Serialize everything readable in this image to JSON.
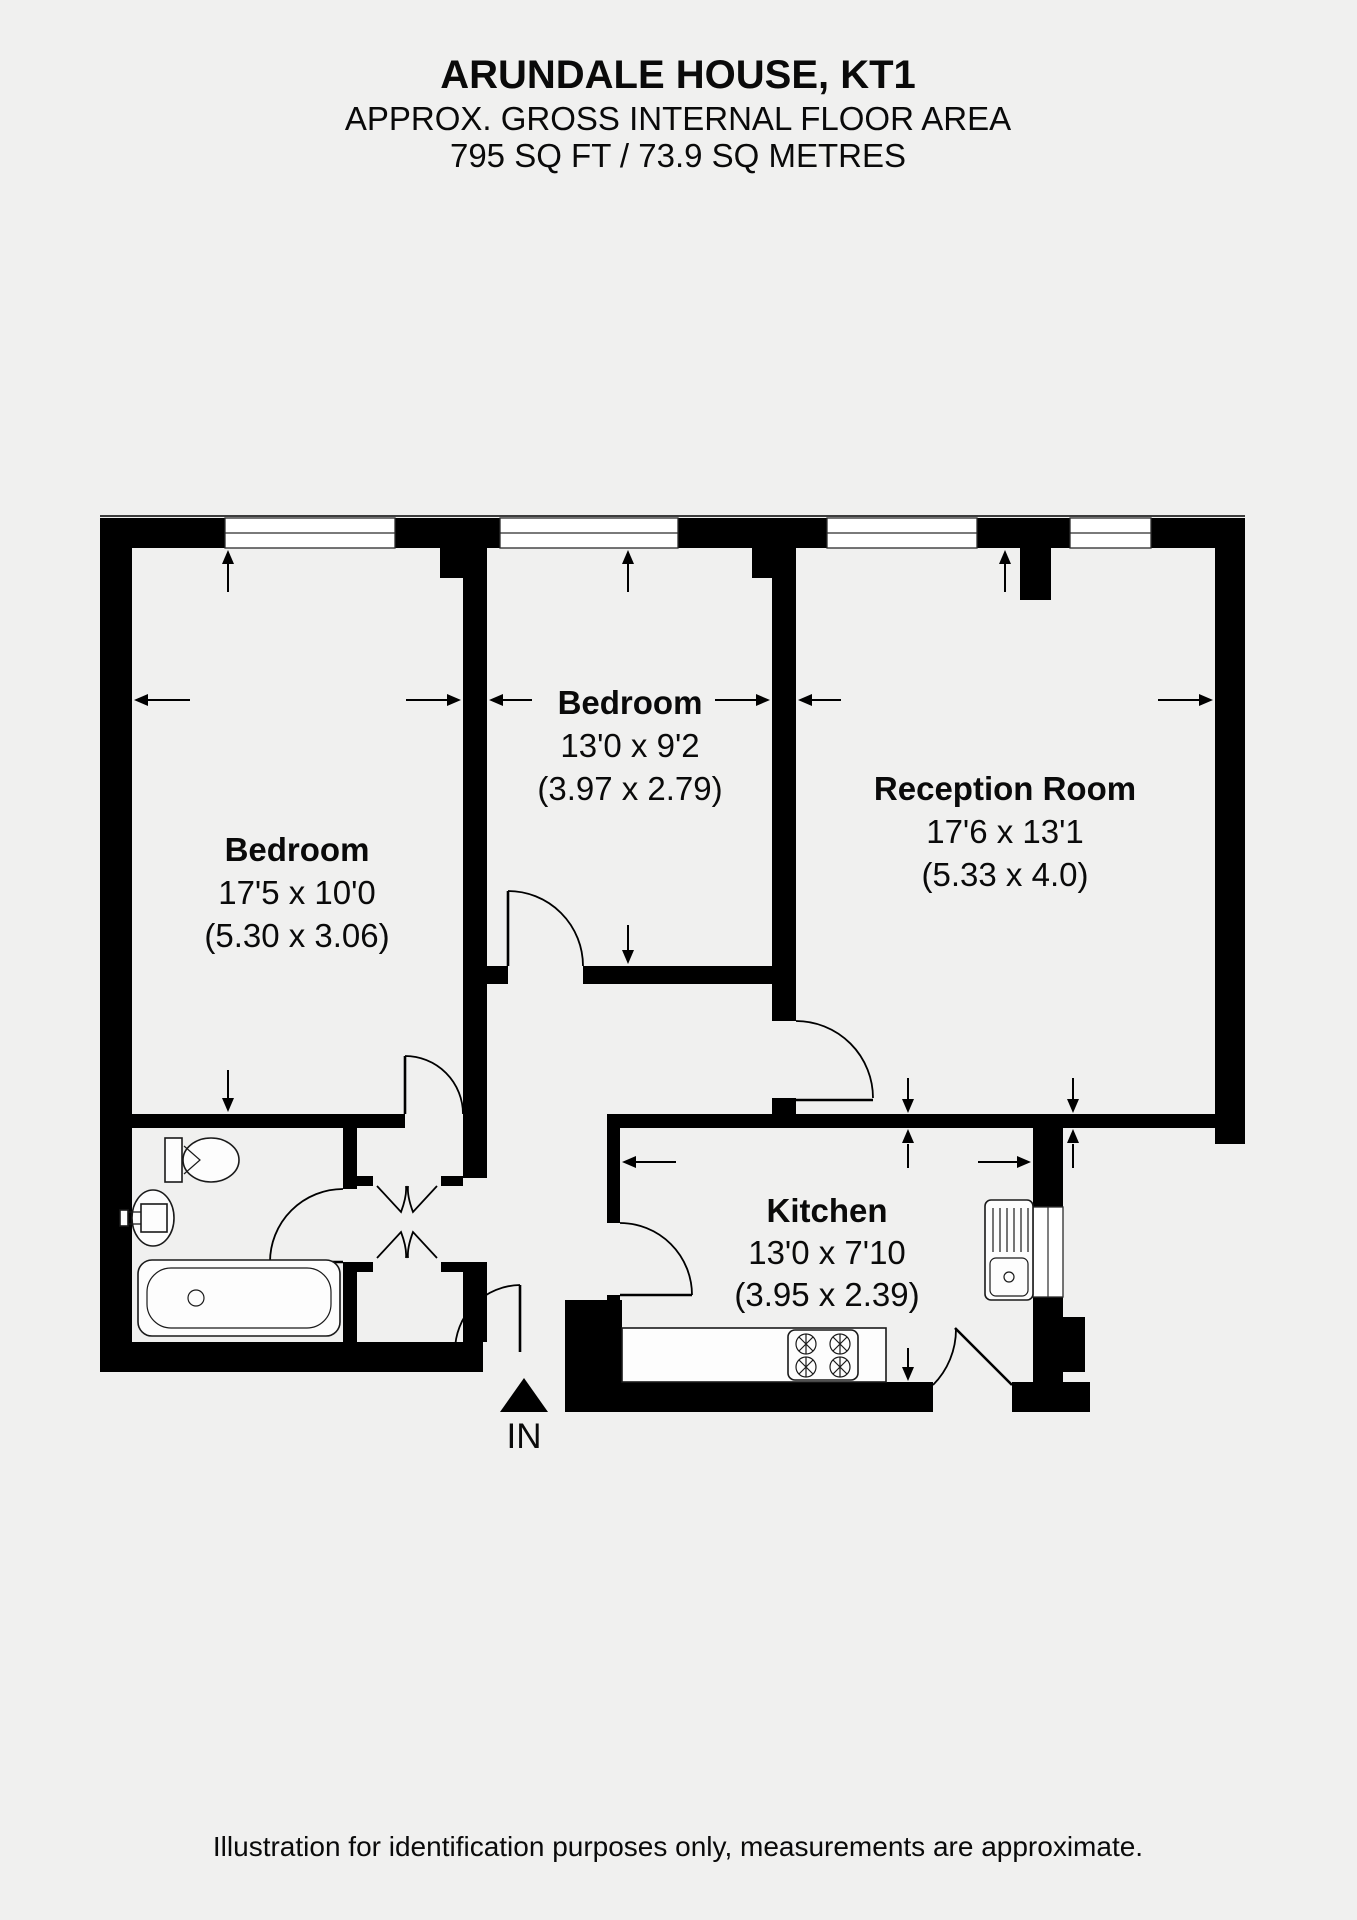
{
  "header": {
    "title": "ARUNDALE HOUSE, KT1",
    "subtitle": "APPROX. GROSS INTERNAL FLOOR AREA",
    "area": "795 SQ FT / 73.9 SQ METRES"
  },
  "rooms": {
    "bedroom1": {
      "name": "Bedroom",
      "imperial": "17'5 x 10'0",
      "metric": "(5.30 x 3.06)"
    },
    "bedroom2": {
      "name": "Bedroom",
      "imperial": "13'0 x 9'2",
      "metric": "(3.97 x 2.79)"
    },
    "reception": {
      "name": "Reception Room",
      "imperial": "17'6 x 13'1",
      "metric": "(5.33 x 4.0)"
    },
    "kitchen": {
      "name": "Kitchen",
      "imperial": "13'0 x 7'10",
      "metric": "(3.95 x 2.39)"
    }
  },
  "entrance": {
    "label": "IN"
  },
  "footer": {
    "disclaimer": "Illustration for identification purposes only, measurements are approximate."
  },
  "icons": {
    "entrance-arrow-icon": "▲",
    "fixtures": [
      "toilet-icon",
      "basin-icon",
      "bathtub-icon",
      "stove-icon",
      "kitchen-sink-icon"
    ]
  },
  "colors": {
    "background": "#f0f0ef",
    "walls": "#000000",
    "fixtures": "#fdfdfd"
  }
}
